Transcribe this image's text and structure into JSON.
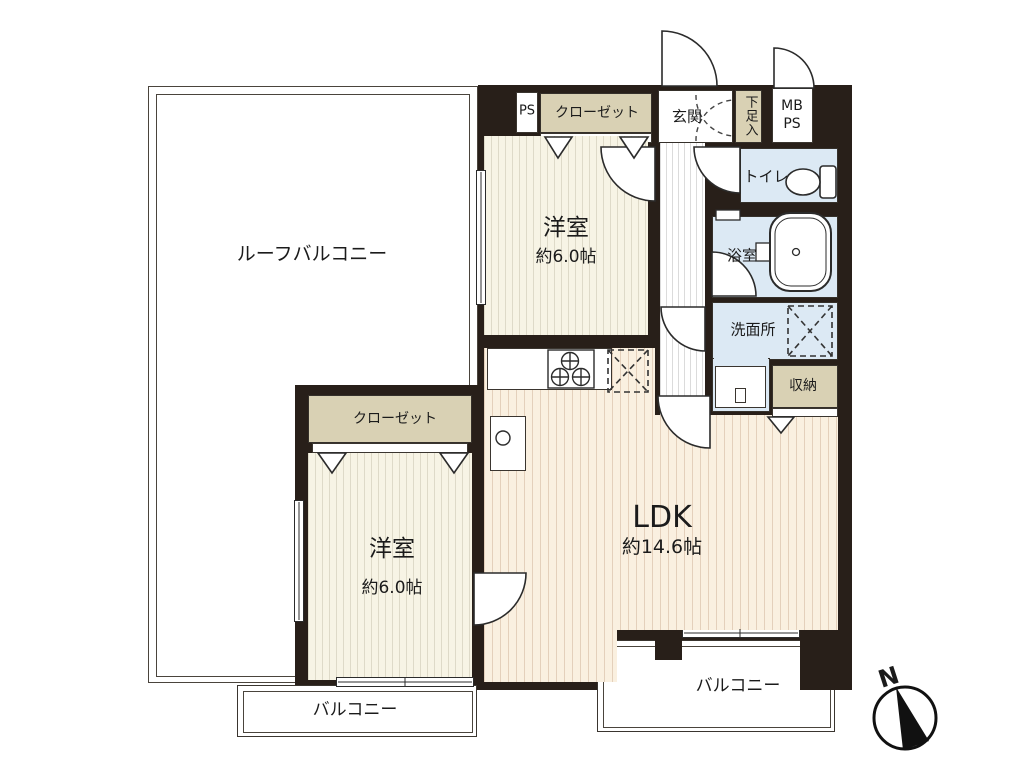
{
  "plan_title": "2LDK floor plan",
  "rooms": {
    "roof_balcony": {
      "label": "ルーフバルコニー"
    },
    "bedroom_top": {
      "label": "洋室",
      "size": "約6.0帖"
    },
    "closet_top": {
      "label": "クローゼット"
    },
    "pipe_space": {
      "label": "PS"
    },
    "entrance": {
      "label": "玄関"
    },
    "shoe_storage": {
      "label": "下足入"
    },
    "meter_box": {
      "line1": "MB",
      "line2": "PS"
    },
    "toilet": {
      "label": "トイレ"
    },
    "bathroom": {
      "label": "浴室"
    },
    "washroom": {
      "label": "洗面所"
    },
    "storage": {
      "label": "収納"
    },
    "ldk": {
      "label": "LDK",
      "size": "約14.6帖"
    },
    "bedroom_bottom": {
      "label": "洋室",
      "size": "約6.0帖"
    },
    "closet_bottom": {
      "label": "クローゼット"
    },
    "balcony_left": {
      "label": "バルコニー"
    },
    "balcony_right": {
      "label": "バルコニー"
    }
  },
  "compass": {
    "label": "N"
  },
  "colors": {
    "wall": "#281f19",
    "closet": "#d9d1b4",
    "wet_room": "#dce9f4",
    "wood_floor": "#faf0e0",
    "cream_floor": "#f7f4e5"
  }
}
